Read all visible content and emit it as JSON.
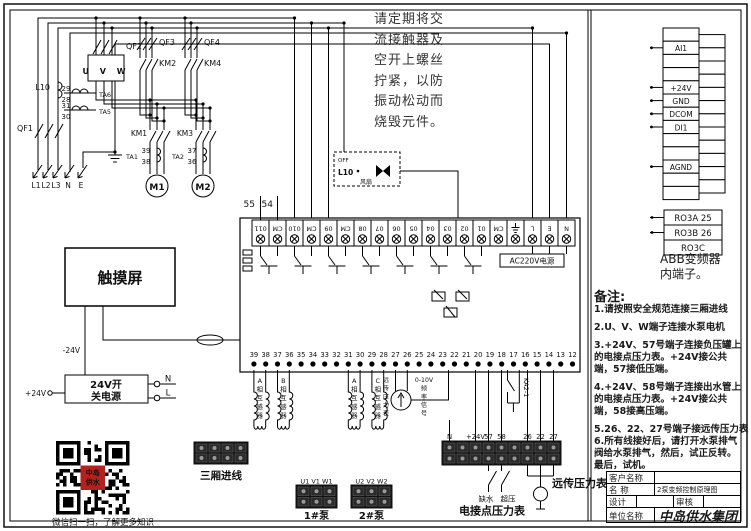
{
  "warning": {
    "text": "请定期将交\n流接触器及\n空开上螺丝\n拧紧，以防\n振动松动而\n烧毁元件。"
  },
  "abb": {
    "terminals": [
      "",
      "AI1",
      "",
      "",
      "+24V",
      "GND",
      "DCOM",
      "DI1",
      "",
      "",
      "AGND",
      "",
      ""
    ],
    "relay_terminals": [
      "RO3A 25",
      "RO3B 26",
      "RO3C"
    ],
    "caption": "ABB变频器\n内端子。"
  },
  "notes": {
    "title": "备注:",
    "items": [
      "1.请按照安全规范连接三厢进线",
      "2.U、V、W端子连接水泵电机",
      "3.+24V、57号端子连接负压罐上的电接点压力表。+24V接公共端，57接低压端。",
      "4.+24V、58号端子连接出水管上的电接点压力表。+24V接公共端，58接高压端。",
      "5.26、22、27号端子接远传压力表",
      "6.所有线接好后，请打开水泵排气阀给水泵排气，然后，试正反转。 最后，试机。"
    ]
  },
  "title_block": {
    "customer_label": "客户名称",
    "customer_value": "",
    "name_label": "名  称",
    "name_value": "2泵变频控制原理图",
    "design_label": "设计",
    "design_value": "",
    "review_label": "审核",
    "review_value": "",
    "unit_label": "单位名称",
    "unit_value": "中岛供水集团"
  },
  "power": {
    "qf1": "QF1",
    "qf2": "QF2",
    "qf3": "QF3",
    "qf4": "QF4",
    "km1": "KM1",
    "km2": "KM2",
    "km3": "KM3",
    "km4": "KM4",
    "m1": "M1",
    "m2": "M2",
    "vfd": "U V W",
    "reactor": "L10",
    "phases": [
      "L1",
      "L2",
      "L3",
      "N",
      "E"
    ],
    "ta6": {
      "label": "TA6",
      "a": "29",
      "b": "28"
    },
    "ta5": {
      "label": "TA5",
      "a": "31",
      "b": "30"
    },
    "ta1": {
      "label": "TA1",
      "a": "39",
      "b": "38"
    },
    "ta2": {
      "label": "TA2",
      "a": "37",
      "b": "36"
    }
  },
  "plc": {
    "top_terminals": [
      "011",
      "CM",
      "010",
      "CM",
      "09",
      "CM",
      "08",
      "07",
      "06",
      "05",
      "04",
      "03",
      "02",
      "01",
      "CM",
      "⏚",
      "L",
      "E",
      "N"
    ],
    "bottom_terminals": [
      "39",
      "38",
      "37",
      "36",
      "35",
      "34",
      "33",
      "32",
      "31",
      "30",
      "29",
      "28",
      "27",
      "26",
      "25",
      "24",
      "23",
      "22",
      "21",
      "20",
      "19",
      "18",
      "17",
      "16",
      "15",
      "14",
      "13",
      "12"
    ],
    "wire55": "55",
    "wire54": "54",
    "power_label": "AC220V电源"
  },
  "fan_box": {
    "off": "OFF",
    "switch": "L10",
    "caption": "风扇"
  },
  "below": {
    "ct_labels": [
      "A相互感器",
      "B相互感器",
      "A相互感器",
      "C相互感器"
    ],
    "gauge_left": "远传压力表",
    "gauge_right": "0-10V频率信号",
    "relay": "KA2-1"
  },
  "touchscreen": {
    "label": "触摸屏",
    "minus": "-24V",
    "plus": "+24V"
  },
  "psu": {
    "line1": "24V开",
    "line2": "关电源",
    "n": "N",
    "l": "L"
  },
  "qr": {
    "caption": "微信扫一扫，了解更多知识",
    "logo": [
      "中岛",
      "供水"
    ]
  },
  "strips": {
    "three_phase": "三厢进线",
    "pump1_header": "U1 V1 W1",
    "pump1": "1#泵",
    "pump2_header": "U2 V2 W2",
    "pump2": "2#泵",
    "gauge_labels": [
      "N",
      "",
      "+24V",
      "57",
      "58",
      "",
      "26",
      "22",
      "27"
    ],
    "switch1": "缺水",
    "switch2": "超压",
    "gauge_caption": "电接点压力表",
    "remote_caption": "远传压力表"
  }
}
